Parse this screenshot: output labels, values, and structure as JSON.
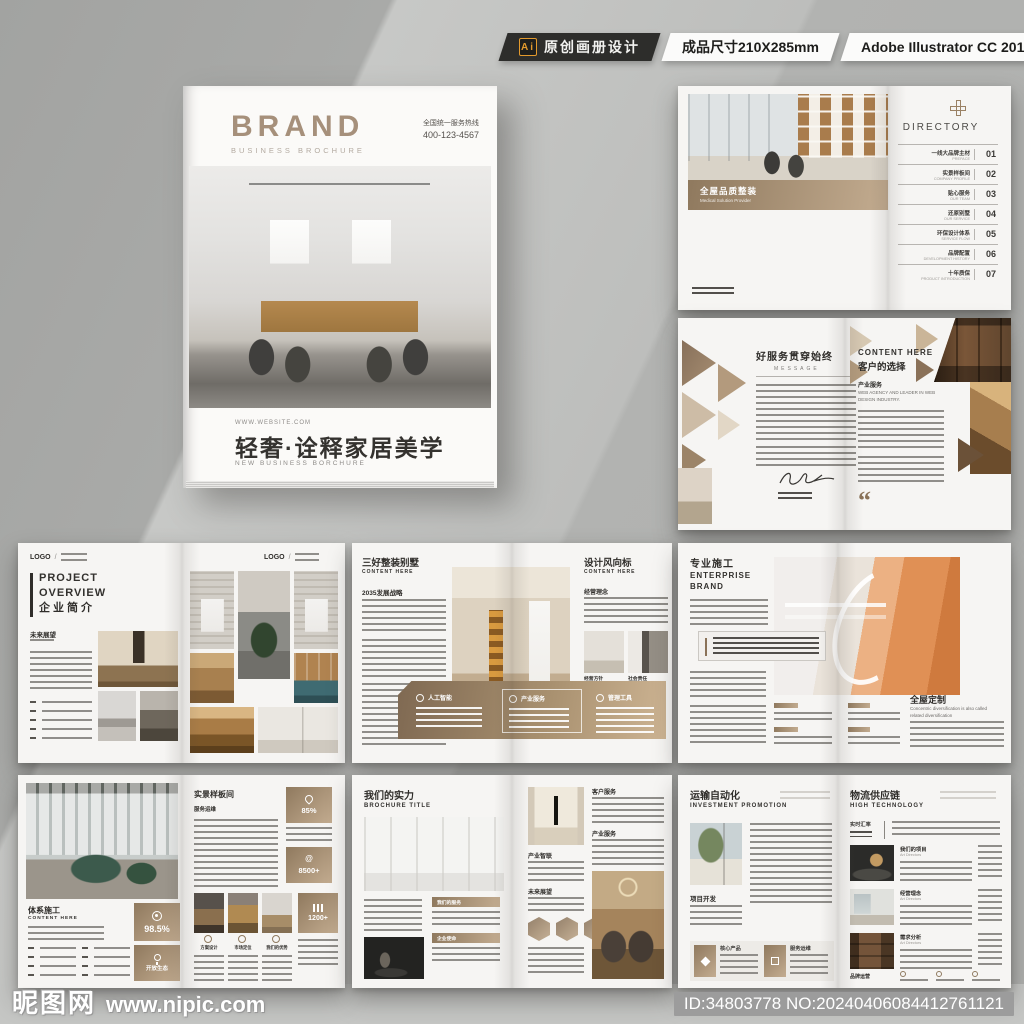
{
  "topbar": {
    "ai": "Ai",
    "original": "原创画册设计",
    "size": "成品尺寸210X285mm",
    "software": "Adobe Illustrator CC 2018"
  },
  "cover": {
    "brand": "BRAND",
    "brand_sub": "BUSINESS BROCHURE",
    "hotline_label": "全国统一服务热线",
    "hotline": "400-123-4567",
    "website": "WWW.WEBSITE.COM",
    "title": "轻奢·诠释家居美学",
    "subtitle": "NEW BUSINESS BORCHURE"
  },
  "s1": {
    "band_title": "全屋品质整装",
    "band_sub": "Medical Solution Provider",
    "dir_title": "DIRECTORY",
    "items": [
      {
        "cn": "一线大品牌主材",
        "en": "PREFACE",
        "num": "01"
      },
      {
        "cn": "实景样板间",
        "en": "COMPANY PROFILE",
        "num": "02"
      },
      {
        "cn": "贴心服务",
        "en": "OUR TEAM",
        "num": "03"
      },
      {
        "cn": "还原别墅",
        "en": "OUR SERVICE",
        "num": "04"
      },
      {
        "cn": "环保设计体系",
        "en": "SERVICE FLOW",
        "num": "05"
      },
      {
        "cn": "品牌配置",
        "en": "DEVELOPMENT HISTORY",
        "num": "06"
      },
      {
        "cn": "十年质保",
        "en": "PRODUCT INTRODUCTION",
        "num": "07"
      }
    ]
  },
  "s2": {
    "left_title": "好服务贯穿始终",
    "left_sub": "MESSAGE",
    "right_title_en": "CONTENT HERE",
    "right_title_cn": "客户的选择",
    "section": "产业服务",
    "section_sub": "WEB AGENCY AND LEADER IN WEB DESIGN INDUSTRY.",
    "quote": "“"
  },
  "s3": {
    "logo": "LOGO",
    "logo_sep": "/",
    "t1": "PROJECT",
    "t2": "OVERVIEW",
    "t3": "企业简介",
    "section": "未来展望"
  },
  "s4": {
    "left_title": "三好整装别墅",
    "left_sub": "CONTENT HERE",
    "left_section": "2035发展战略",
    "right_title": "设计风向标",
    "right_sub": "CONTENT HERE",
    "right_section": "经营理念",
    "cap1": "经营方针",
    "cap2": "社会责任",
    "band": [
      {
        "label": "人工智能"
      },
      {
        "label": "产业服务"
      },
      {
        "label": "管理工具"
      }
    ]
  },
  "s5": {
    "title": "专业施工",
    "sub1": "ENTERPRISE",
    "sub2": "BRAND",
    "right_title": "全屋定制",
    "right_caption": "Concentric diversification is also called related diversification"
  },
  "s6": {
    "left_title": "体系施工",
    "left_sub": "CONTENT HERE",
    "right_title": "实景样板间",
    "right_section": "服务运维",
    "stat1": "85%",
    "stat2": "8500+",
    "stat3": "98.5%",
    "stat4": "开放生态",
    "stat5": "1200+",
    "cap1": "方案设计",
    "cap2": "市场定位",
    "cap3": "我们的优势"
  },
  "s7": {
    "title": "我们的实力",
    "sub": "BROCHURE TITLE",
    "label1": "我们的服务",
    "label2": "企业使命",
    "colA1": "产业智联",
    "colA2": "未来展望",
    "colB1": "客户服务",
    "colB2": "产业服务"
  },
  "s8": {
    "title": "运输自动化",
    "sub": "INVESTMENT PROMOTION",
    "section": "项目开发",
    "box1": "核心产品",
    "box2": "服务运维",
    "right_title": "物流供应链",
    "right_sub": "HIGH TECHNOLOGY",
    "sidebar": "实时汇率",
    "row1": "我们的项目",
    "row2": "经营理念",
    "row3": "需求分析",
    "row_sub": "Art Directors",
    "footer": "品牌运营"
  },
  "wm": {
    "site": "昵图网",
    "url": "www.nipic.com",
    "id": "ID:34803778 NO:20240406084412761121"
  }
}
